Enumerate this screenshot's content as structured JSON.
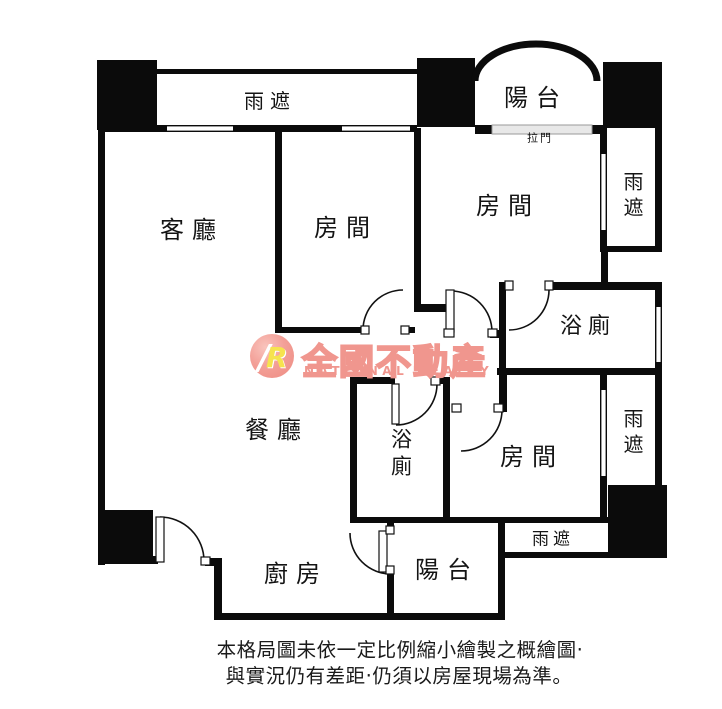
{
  "labels": {
    "canopy_top": "雨遮",
    "balcony_top": "陽台",
    "sliding_door": "拉門",
    "canopy_right_upper": "雨遮",
    "living_room": "客廳",
    "bedroom_middle": "房間",
    "bedroom_right": "房間",
    "bathroom_upper": "浴廁",
    "dining_room": "餐廳",
    "bathroom_lower": "浴廁",
    "bedroom_bottom": "房間",
    "canopy_right_lower": "雨遮",
    "canopy_bottom": "雨遮",
    "kitchen": "廚房",
    "balcony_bottom": "陽台"
  },
  "watermark": {
    "logo_letter": "R",
    "logo_slash": "/",
    "brand": "全國不動產",
    "brand_en": "NATIONAL REALTY",
    "color": "#f0968e"
  },
  "disclaimer": {
    "line1": "本格局圖未依一定比例縮小繪製之概繪圖‧",
    "line2": "與實況仍有差距‧仍須以房屋現場為準。"
  },
  "colors": {
    "wall": "#0b0b0b",
    "background": "#ffffff",
    "sliding_door_fill": "#e8e8e8"
  }
}
